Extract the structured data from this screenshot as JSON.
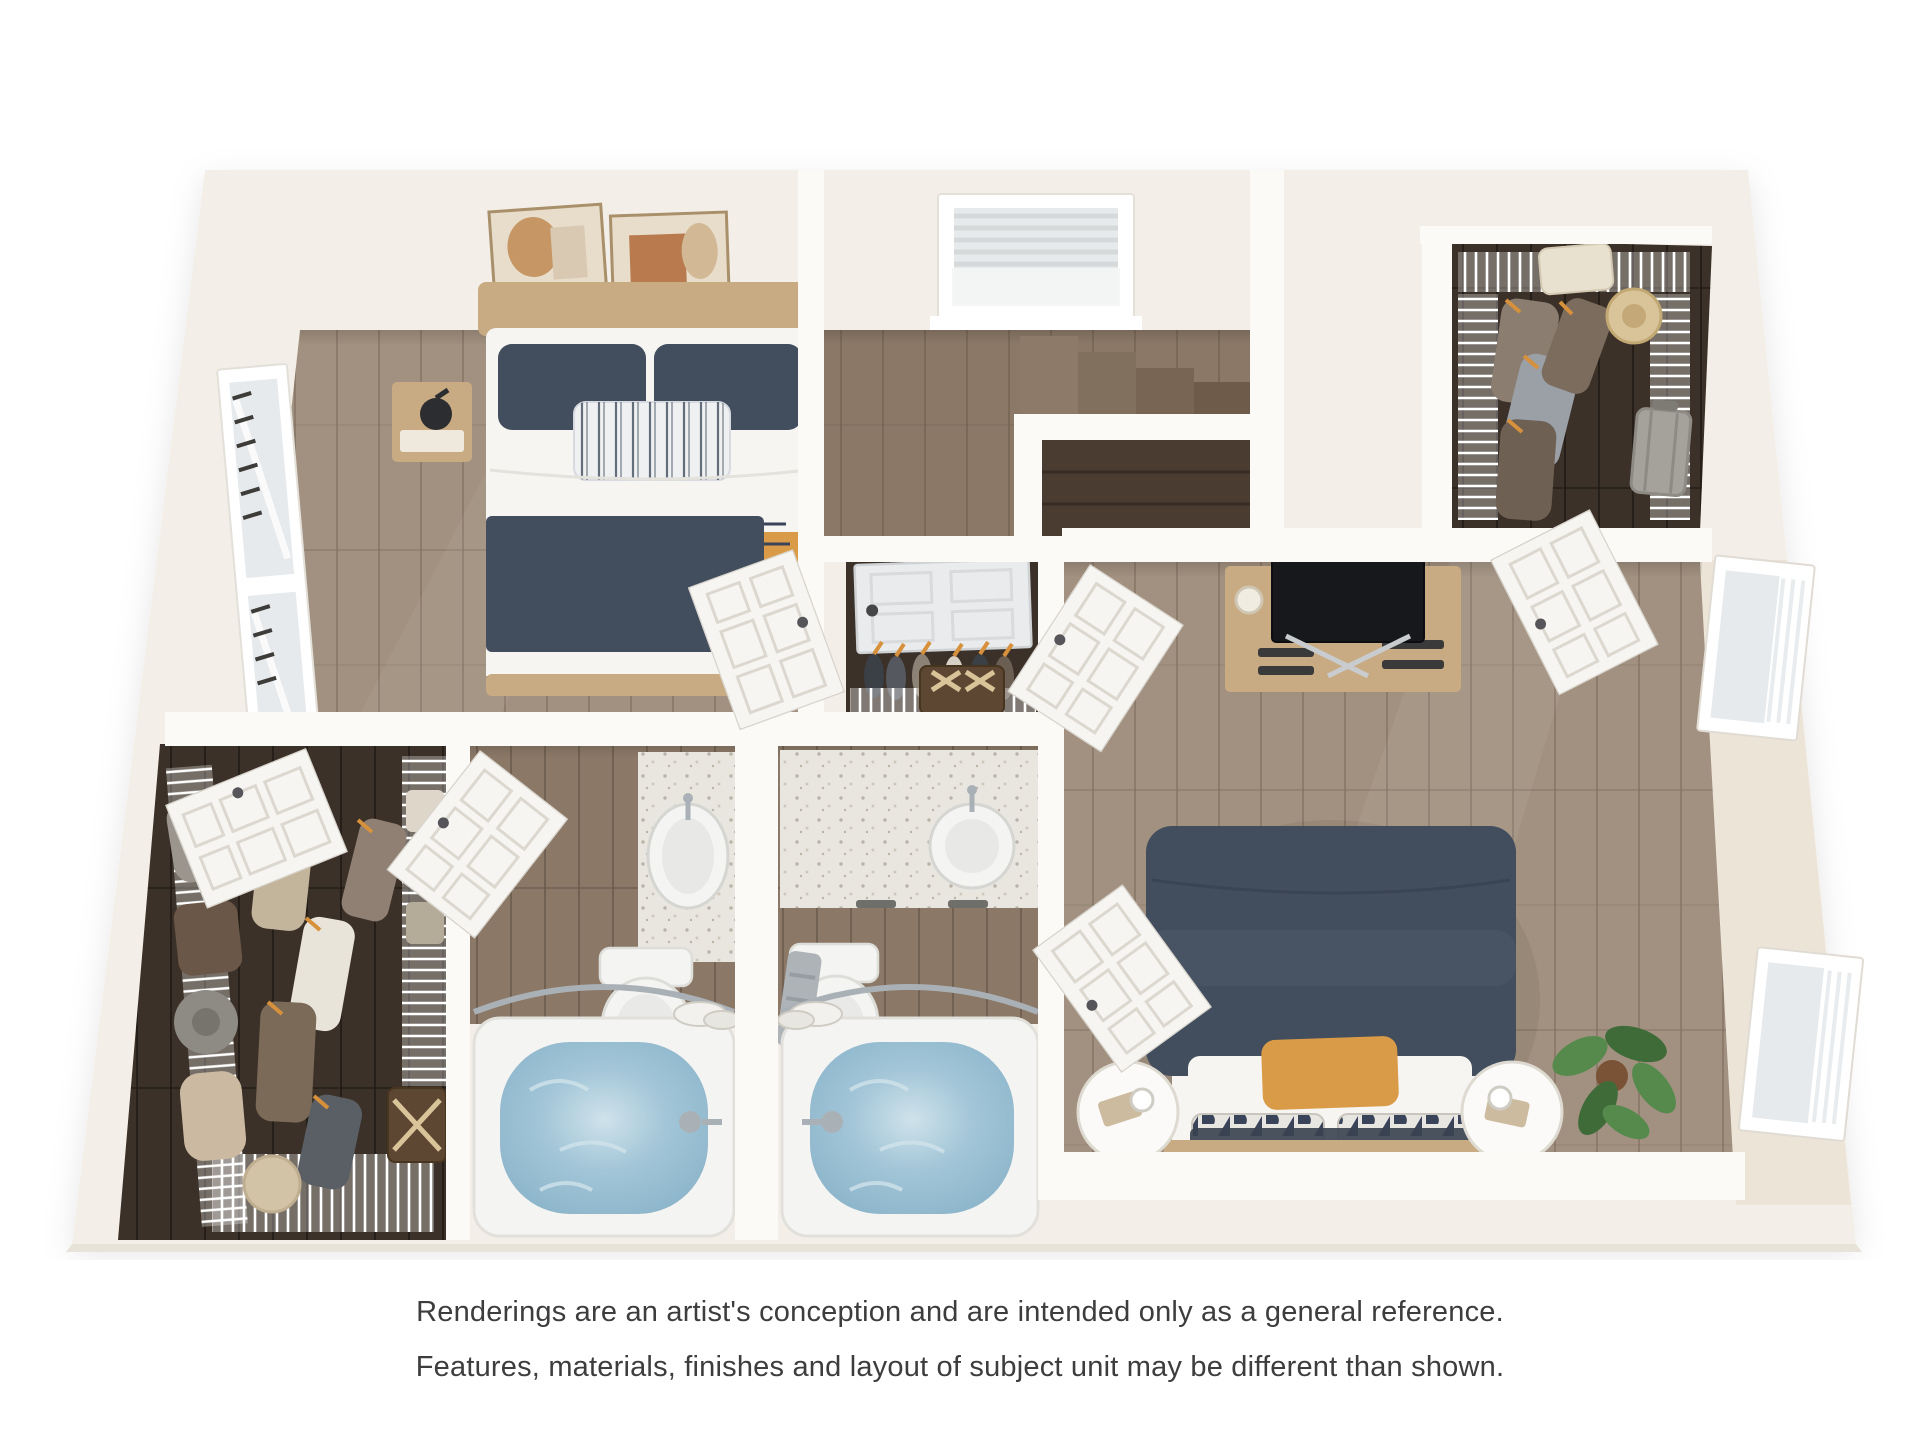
{
  "disclaimer": {
    "line1": "Renderings are an artist's conception and are intended only as a general reference.",
    "line2": "Features, materials, finishes and layout of subject unit may be different than shown."
  },
  "colors": {
    "pageBg": "#ffffff",
    "shell": "#f3efe8",
    "shellEdge": "#e8e3d9",
    "band": "#ece4d7",
    "wall": "#fbfaf7",
    "floorLight": "#a29180",
    "floorMid": "#8b7867",
    "floorDark": "#3c3128",
    "floorVoid": "#4a3c31",
    "plank": "rgba(70,52,38,0.22)",
    "linen": "#f6f5f1",
    "navy": "#424d5d",
    "navyDeep": "#39435a",
    "mustard": "#d99b48",
    "wood": "#c8ab83",
    "woodDark": "#a9885f",
    "chrome": "#aab1b6",
    "glass": "#e6eaec",
    "door": "#f6f5f2",
    "counter": "#e9e6df",
    "speckleA": "#b9b3a8",
    "speckleB": "#cfc9bd",
    "porcelain": "#f4f4f2",
    "waterHi": "#cfe2ea",
    "waterMid": "#a3c6d8",
    "waterDeep": "#8ab3c9",
    "trunk": "#5d4632",
    "tan": "#cdbb9f",
    "green": "#558a4c",
    "greenDark": "#3f6b39",
    "text": "#3d3d3d"
  },
  "scene": {
    "kind": "3d-dollhouse-floor-plan-rendering",
    "rooms": [
      {
        "name": "bedroom-secondary",
        "furnishings": [
          "bed",
          "pillows",
          "throw-blanket",
          "nightstands",
          "table-lamps",
          "framed-art",
          "window"
        ]
      },
      {
        "name": "stair-hall",
        "furnishings": [
          "window-with-blinds",
          "staircase",
          "stairwell-railing"
        ]
      },
      {
        "name": "walk-in-closet-master",
        "furnishings": [
          "wire-shelving",
          "hanging-clothes",
          "fedora-hat",
          "suitcase",
          "folded-blanket"
        ]
      },
      {
        "name": "master-bedroom",
        "furnishings": [
          "bed",
          "accent-pillows",
          "round-side-tables",
          "dresser",
          "television",
          "monstera-plant",
          "windows",
          "doors"
        ]
      },
      {
        "name": "shoe-closet",
        "furnishings": [
          "door",
          "boot-hangers",
          "storage-trunk",
          "wire-shelf"
        ]
      },
      {
        "name": "bathroom-left",
        "furnishings": [
          "door",
          "vanity-sink",
          "toilet",
          "bathtub-filled",
          "shower-rod"
        ]
      },
      {
        "name": "bathroom-right",
        "furnishings": [
          "vanity-sink",
          "toilet",
          "towel",
          "bathtub-filled",
          "shower-rod",
          "door"
        ]
      },
      {
        "name": "walk-in-closet-secondary",
        "furnishings": [
          "wire-shelving",
          "hanging-clothes",
          "hats",
          "bags",
          "storage-trunk",
          "pouf"
        ]
      }
    ]
  }
}
